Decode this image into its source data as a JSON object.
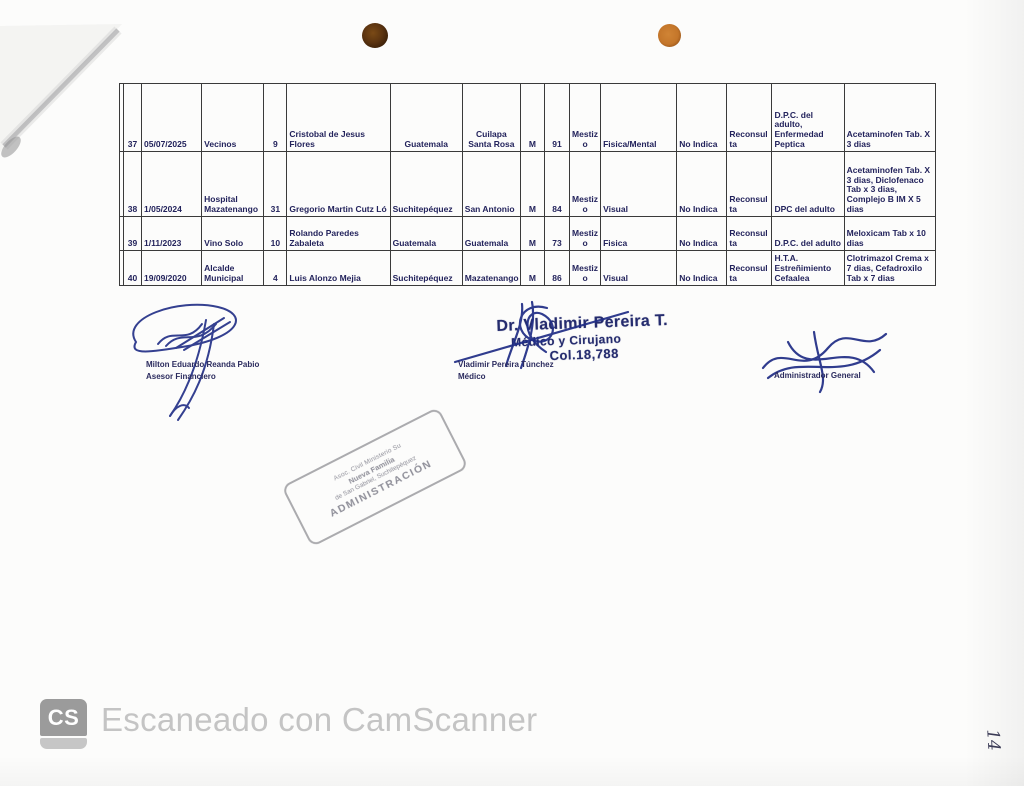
{
  "colors": {
    "ink_navy": "#23235c",
    "pen_blue": "#1f2c85",
    "stamp_gray": "#8e8e98",
    "camscanner_gray": "#c4c4c4",
    "punch_hole_left": "#5c3410",
    "punch_hole_right": "#c4762a"
  },
  "table": {
    "rows": [
      {
        "no": "37",
        "date": "05/07/2025",
        "referral": "Vecinos",
        "num": "9",
        "name": "Cristobal de Jesus Flores",
        "dept": "Guatemala",
        "muni": "Cuilapa Santa Rosa",
        "sex": "M",
        "age": "91",
        "ethnicity": "Mestizo",
        "condition": "Fisica/Mental",
        "indicator": "No Indica",
        "visit": "Reconsulta",
        "diagnosis": "D.P.C. del adulto, Enfermedad Peptica",
        "treatment": "Acetaminofen Tab. X 3 dias"
      },
      {
        "no": "38",
        "date": "1/05/2024",
        "referral": "Hospital Mazatenango",
        "num": "31",
        "name": "Gregorio Martin Cutz Ló",
        "dept": "Suchitepéquez",
        "muni": "San Antonio",
        "sex": "M",
        "age": "84",
        "ethnicity": "Mestizo",
        "condition": "Visual",
        "indicator": "No Indica",
        "visit": "Reconsulta",
        "diagnosis": "DPC del adulto",
        "treatment": "Acetaminofen Tab. X 3 dias, Diclofenaco Tab x 3 dias, Complejo B IM X 5 dias"
      },
      {
        "no": "39",
        "date": "1/11/2023",
        "referral": "Vino Solo",
        "num": "10",
        "name": "Rolando Paredes Zabaleta",
        "dept": "Guatemala",
        "muni": "Guatemala",
        "sex": "M",
        "age": "73",
        "ethnicity": "Mestizo",
        "condition": "Fisica",
        "indicator": "No Indica",
        "visit": "Reconsulta",
        "diagnosis": "D.P.C. del adulto",
        "treatment": "Meloxicam Tab x 10 dias"
      },
      {
        "no": "40",
        "date": "19/09/2020",
        "referral": "Alcalde Municipal",
        "num": "4",
        "name": "Luis Alonzo Mejia",
        "dept": "Suchitepéquez",
        "muni": "Mazatenango",
        "sex": "M",
        "age": "86",
        "ethnicity": "Mestizo",
        "condition": "Visual",
        "indicator": "No Indica",
        "visit": "Reconsulta",
        "diagnosis": "H.T.A. Estreñimiento Cefaalea",
        "treatment": "Clotrimazol Crema x 7 dias, Cefadroxilo Tab x 7 dias"
      }
    ]
  },
  "signatures": {
    "left": {
      "name": "Milton  Eduardo Reanda Pabio",
      "title": "Asesor Financiero"
    },
    "center": {
      "name": "Vladimir Pereira Túnchez",
      "title": "Médico",
      "stamp_line1": "Dr. Vladimir Pereira T.",
      "stamp_line2": "Médico y Cirujano",
      "stamp_line3": "Col.18,788"
    },
    "right": {
      "title": "Administrador General"
    }
  },
  "admin_stamp": {
    "line1": "Asoc. Civil Ministerio Su",
    "line2": "Nueva Familia",
    "line3": "de San Gabriel, Suchitepéquez",
    "line4": "ADMINISTRACIÓN"
  },
  "page_number": "14",
  "scanner": {
    "badge": "CS",
    "caption": "Escaneado con CamScanner"
  }
}
